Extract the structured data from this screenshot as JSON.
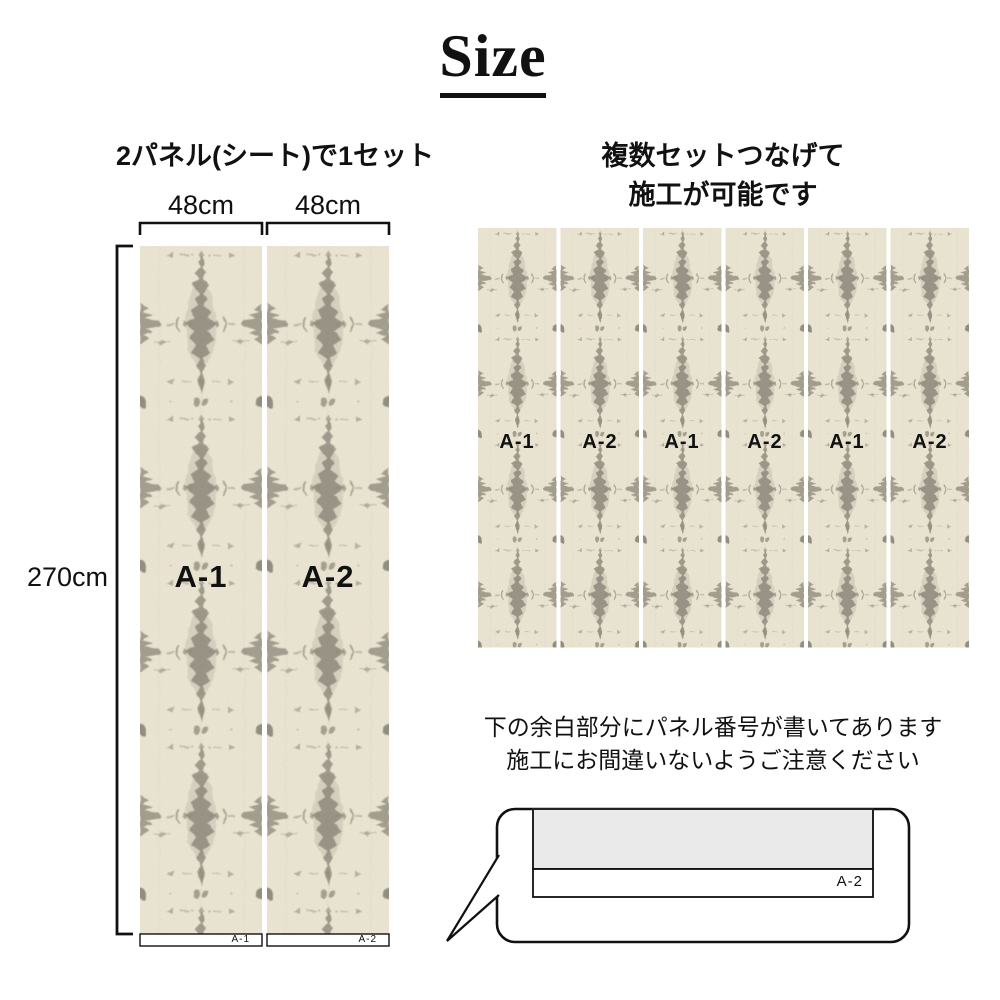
{
  "title": {
    "text": "Size"
  },
  "left_section": {
    "heading": "2パネル(シート)で1セット",
    "width_labels": [
      "48cm",
      "48cm"
    ],
    "height_label": "270cm",
    "panels": [
      {
        "label": "A-1",
        "tag": "A-1"
      },
      {
        "label": "A-2",
        "tag": "A-2"
      }
    ]
  },
  "right_section": {
    "heading_line1": "複数セットつなげて",
    "heading_line2": "施工が可能です",
    "panel_labels": [
      "A-1",
      "A-2",
      "A-1",
      "A-2",
      "A-1",
      "A-2"
    ]
  },
  "note": {
    "line1": "下の余白部分にパネル番号が書いてあります",
    "line2": "施工にお間違いないようご注意ください"
  },
  "bubble": {
    "tag": "A-2"
  },
  "colors": {
    "page_bg": "#FFFFFF",
    "pattern_bg": "#ECE6D3",
    "pattern_ink": "#8A8577",
    "diagram_gray": "#EAEAEA",
    "text": "#111111"
  }
}
